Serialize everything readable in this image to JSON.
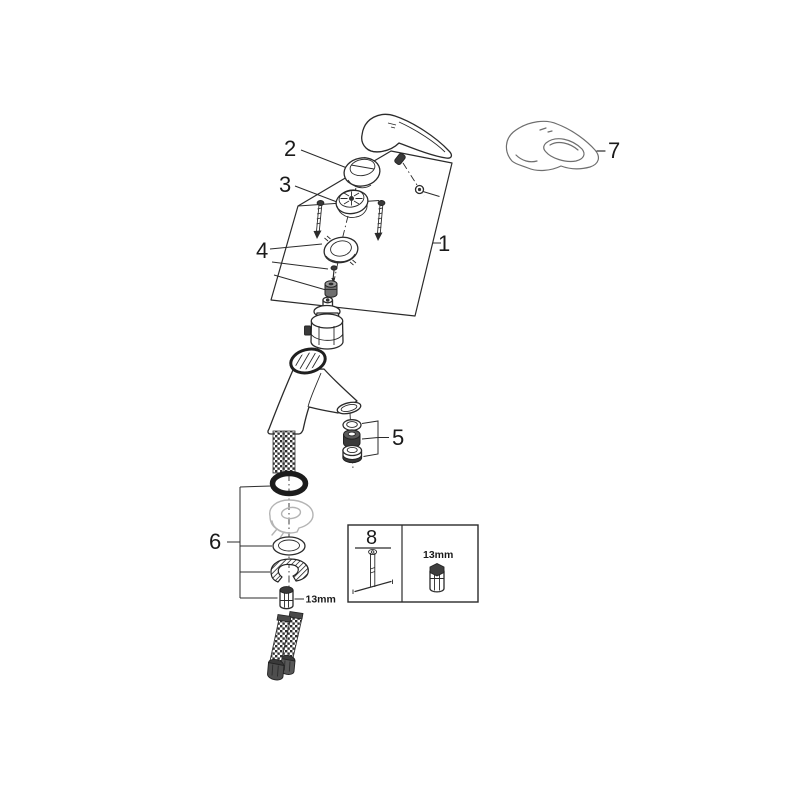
{
  "figure": {
    "kind": "exploded-parts-diagram",
    "background": "#ffffff",
    "ink_color": "#2b2b2b",
    "ghost_color": "#b4b4b4"
  },
  "callouts": {
    "c1": "1",
    "c2": "2",
    "c3": "3",
    "c4": "4",
    "c5": "5",
    "c6": "6",
    "c7": "7",
    "c8": "8"
  },
  "labels": {
    "nut_size": "13mm",
    "tool_size": "13mm"
  }
}
